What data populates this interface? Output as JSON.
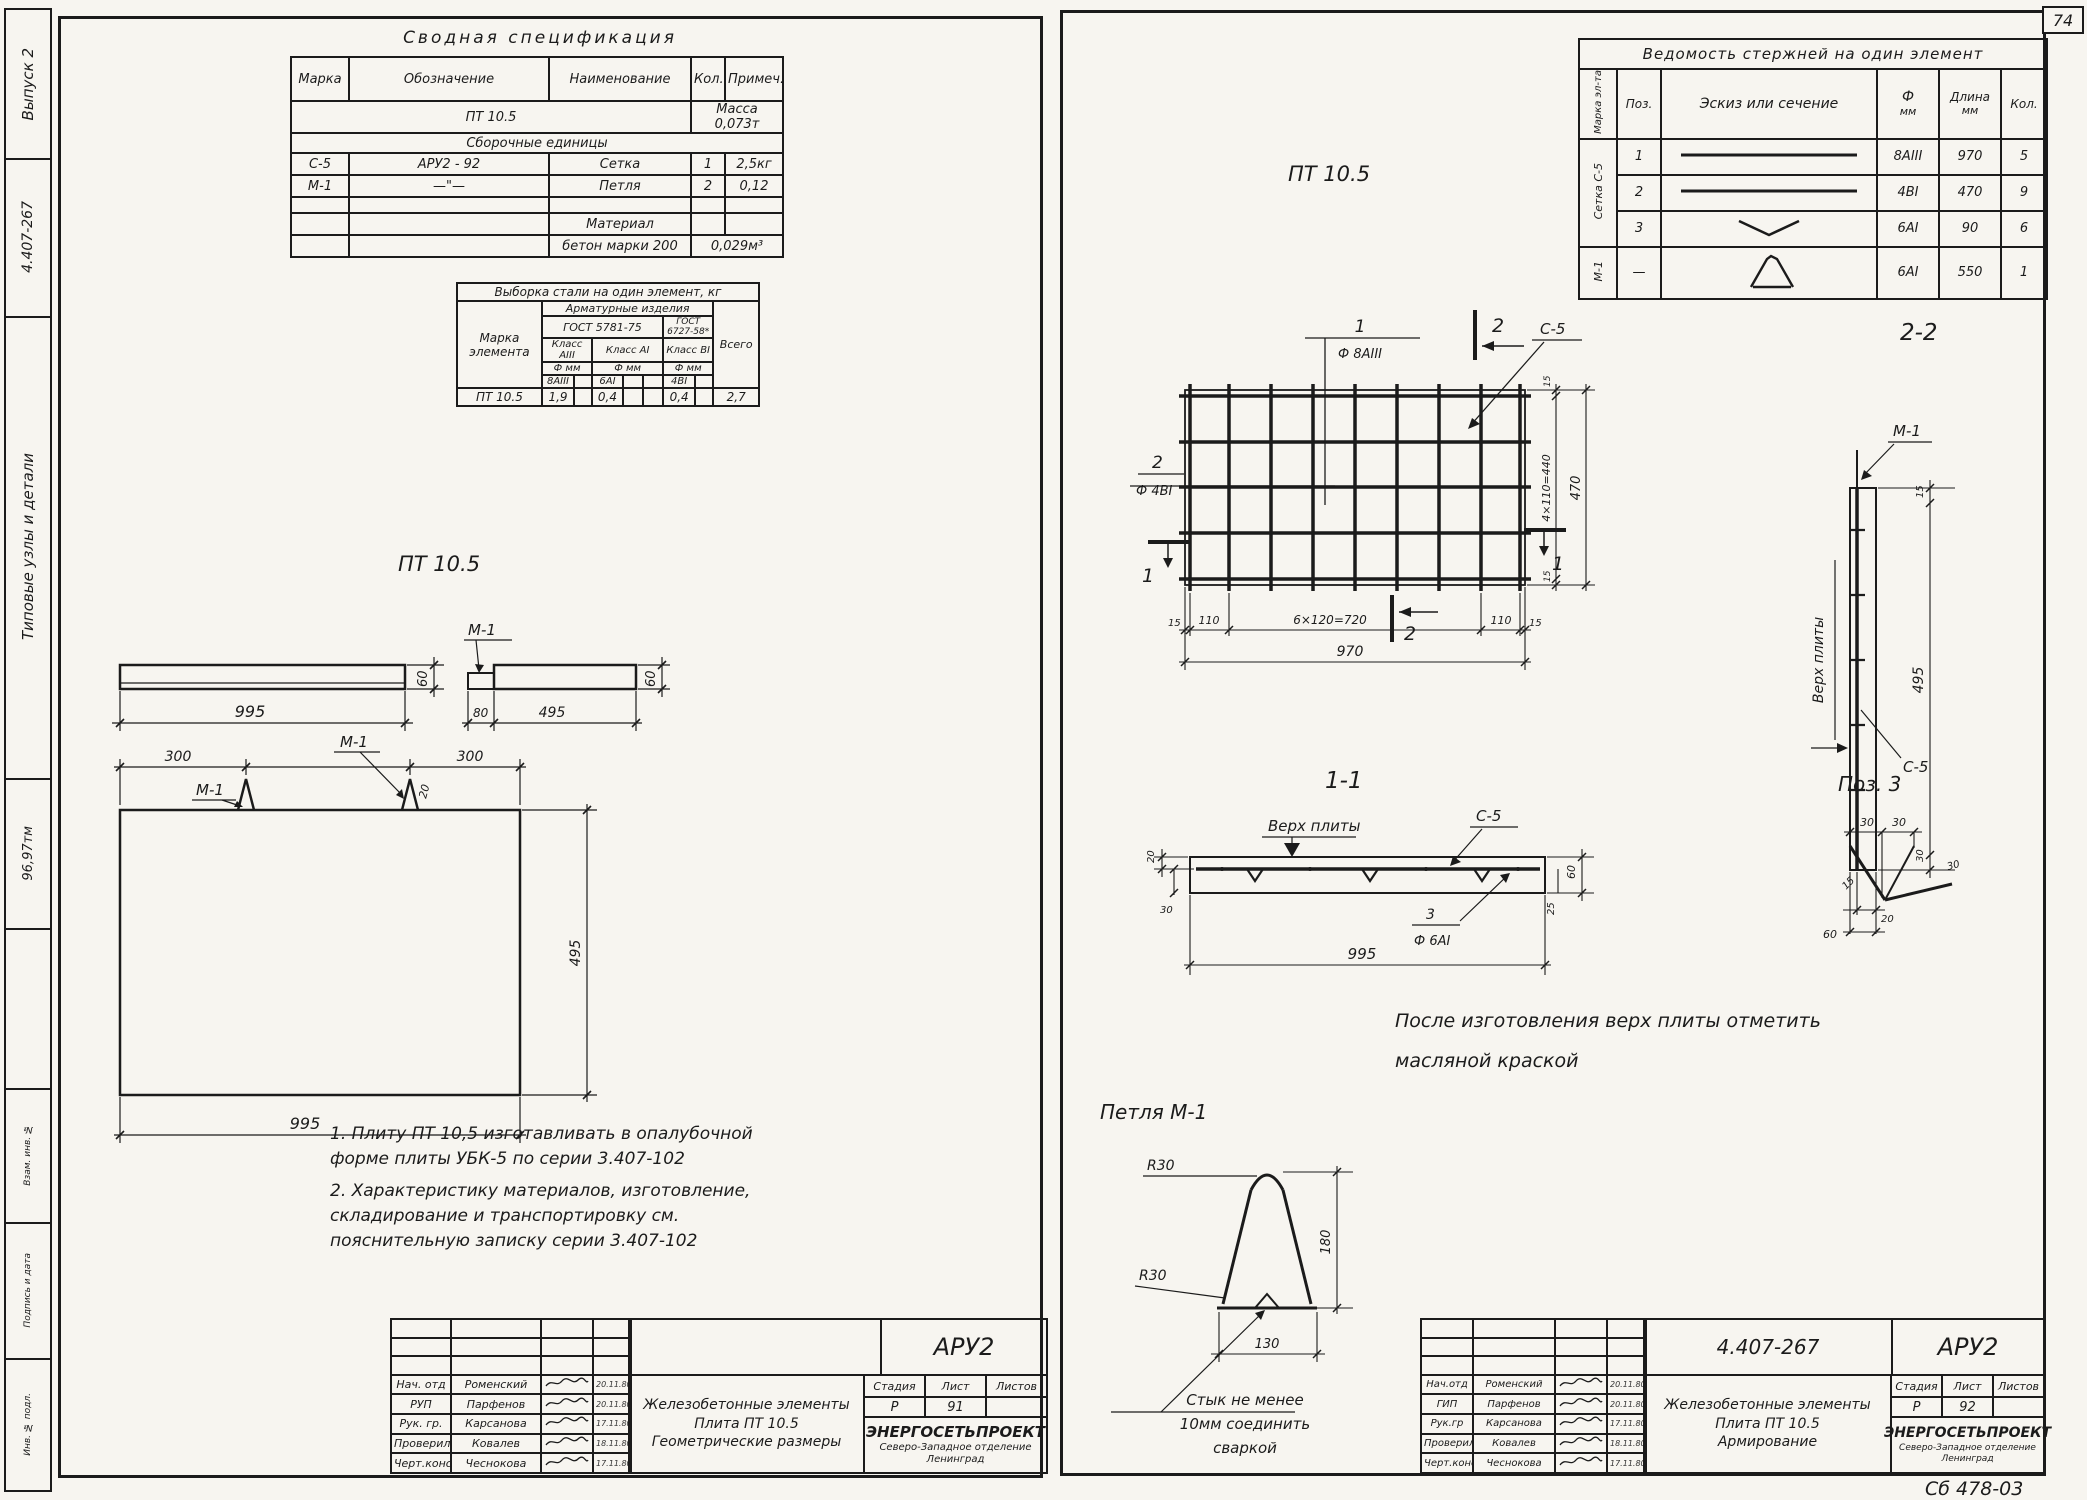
{
  "colors": {
    "ink": "#1b1b1b",
    "paper": "#f7f5f0"
  },
  "page_number": "74",
  "footer_mark": "Сб 478-03",
  "margin": {
    "issue": "Выпуск 2",
    "series": "4.407-267",
    "strip_title": "Типовые узлы и детали",
    "code": "96,97тм",
    "box_top": "Взам. инв. №",
    "box_mid": "Подпись и дата",
    "box_bot": "Инв. № подл."
  },
  "spec": {
    "title": "Сводная спецификация",
    "h": [
      "Марка",
      "Обозначение",
      "Наименование",
      "Кол.",
      "Примеч."
    ],
    "r_item": "ПТ 10.5",
    "r_mass": "Масса 0,073т",
    "r_section": "Сборочные единицы",
    "rows": [
      [
        "С-5",
        "АРУ2 - 92",
        "Сетка",
        "1",
        "2,5кг"
      ],
      [
        "М-1",
        "—\"—",
        "Петля",
        "2",
        "0,12"
      ]
    ],
    "material_label": "Материал",
    "material_name": "бетон марки 200",
    "material_qty": "0,029м³"
  },
  "steel": {
    "title": "Выборка стали на один элемент, кг",
    "mark": "Марка элемента",
    "group": "Арматурные изделия",
    "gost1": "ГОСТ 5781-75",
    "gost2": "ГОСТ 6727-58*",
    "cls1": "Класс АIII",
    "cls2": "Класс АI",
    "cls3": "Класс ВI",
    "f1": "Ф мм",
    "f2": "Ф мм",
    "f3": "Ф мм",
    "d1": "8АIII",
    "d2": "6АI",
    "d3": "4ВI",
    "total": "Всего",
    "row": [
      "ПТ 10.5",
      "1,9",
      "0,4",
      "0,4",
      "2,7"
    ]
  },
  "geom": {
    "heading": "ПТ 10.5",
    "m1a": "М-1",
    "m1b": "М-1",
    "m1c": "М-1",
    "elev_w": "995",
    "elev_h": "60",
    "end_80": "80",
    "end_495": "495",
    "end_60": "60",
    "plan_300a": "300",
    "plan_300b": "300",
    "plan_20": "20",
    "plan_495": "495",
    "plan_995": "995"
  },
  "notes": {
    "n1": "1. Плиту ПТ 10,5 изготавливать в опалубочной форме плиты УБК-5 по серии 3.407-102",
    "n2": "2. Характеристику материалов, изготовление, складирование и транспортировку см. пояснительную записку серии 3.407-102"
  },
  "rods": {
    "title": "Ведомость стержней на один элемент",
    "h_mark": "Марка эл-та",
    "h_pos": "Поз.",
    "h_sketch": "Эскиз или сечение",
    "h_dia1": "Ф",
    "h_dia2": "мм",
    "h_len1": "Длина",
    "h_len2": "мм",
    "h_qty": "Кол.",
    "g1": "Сетка С-5",
    "g2": "М-1",
    "rows": [
      [
        "1",
        "8АIII",
        "970",
        "5"
      ],
      [
        "2",
        "4ВI",
        "470",
        "9"
      ],
      [
        "3",
        "6АI",
        "90",
        "6"
      ],
      [
        "—",
        "6АI",
        "550",
        "1"
      ]
    ]
  },
  "mesh": {
    "heading": "ПТ 10.5",
    "c1n": "1",
    "c1d": "Ф 8АIII",
    "c2n": "2",
    "c2d": "Ф 4ВI",
    "mark": "С-5",
    "s2a": "2",
    "s2b": "2",
    "s1a": "1",
    "s1b": "1",
    "r15a": "15",
    "r440": "4×110=440",
    "r15b": "15",
    "r470": "470",
    "b15a": "15",
    "b110a": "110",
    "b720": "6×120=720",
    "b110b": "110",
    "b15b": "15",
    "b970": "970"
  },
  "sec22": {
    "heading": "2-2",
    "m1": "М-1",
    "top": "Верх плиты",
    "c5": "С-5",
    "d15": "15",
    "d495": "495",
    "d30": "30",
    "d20": "20",
    "d60": "60"
  },
  "sec11": {
    "heading": "1-1",
    "top": "Верх плиты",
    "c5": "С-5",
    "p3": "3",
    "p3d": "Ф 6АI",
    "d20": "20",
    "d30": "30",
    "d995": "995",
    "d60": "60",
    "d25": "25"
  },
  "pos3": {
    "heading": "Поз. 3",
    "d30a": "30",
    "d30b": "30",
    "d15": "15",
    "d30c": "30"
  },
  "rnote": {
    "l1": "После изготовления верх плиты отметить",
    "l2": "масляной краской"
  },
  "loop": {
    "heading": "Петля М-1",
    "r1": "R30",
    "r2": "R30",
    "d180": "180",
    "d130": "130",
    "n1": "Стык не менее",
    "n2": "10мм соединить",
    "n3": "сваркой"
  },
  "tbl": {
    "doc": "АРУ2",
    "code": "",
    "t1": "Железобетонные элементы",
    "t2": "Плита ПТ 10.5",
    "t3": "Геометрические размеры",
    "sh": [
      "Стадия",
      "Лист",
      "Листов"
    ],
    "stage": "Р",
    "sheet": "91",
    "sheets": "",
    "org1": "ЭНЕРГОСЕТЬПРОЕКТ",
    "org2": "Северо-Западное отделение",
    "org3": "Ленинград",
    "roles": [
      "Нач. отд",
      "РУП",
      "Рук. гр.",
      "Проверил",
      "Черт.конс"
    ],
    "names": [
      "Роменский",
      "Парфенов",
      "Карсанова",
      "Ковалев",
      "Чеснокова"
    ],
    "dates": [
      "20.11.80",
      "20.11.80",
      "17.11.80",
      "18.11.80",
      "17.11.80"
    ]
  },
  "tbr": {
    "doc": "АРУ2",
    "code": "4.407-267",
    "t1": "Железобетонные элементы",
    "t2": "Плита ПТ 10.5",
    "t3": "Армирование",
    "sh": [
      "Стадия",
      "Лист",
      "Листов"
    ],
    "stage": "Р",
    "sheet": "92",
    "sheets": "",
    "org1": "ЭНЕРГОСЕТЬПРОЕКТ",
    "org2": "Северо-Западное отделение",
    "org3": "Ленинград",
    "roles": [
      "Нач.отд",
      "ГИП",
      "Рук.гр",
      "Проверил",
      "Черт.конс"
    ],
    "names": [
      "Роменский",
      "Парфенов",
      "Карсанова",
      "Ковалев",
      "Чеснокова"
    ],
    "dates": [
      "20.11.80",
      "20.11.80",
      "17.11.80",
      "18.11.80",
      "17.11.80"
    ]
  }
}
